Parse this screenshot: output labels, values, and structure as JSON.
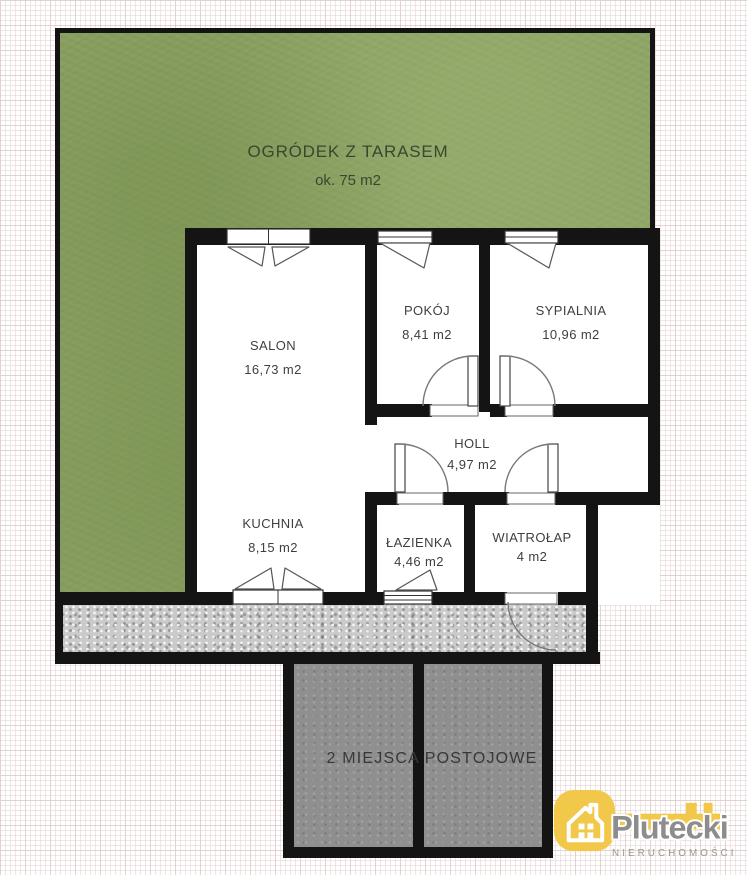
{
  "garden": {
    "name": "OGRÓDEK Z TARASEM",
    "area": "ok. 75 m2"
  },
  "rooms": [
    {
      "id": "salon",
      "name": "SALON",
      "area": "16,73 m2"
    },
    {
      "id": "pokoj",
      "name": "POKÓJ",
      "area": "8,41 m2"
    },
    {
      "id": "sypialnia",
      "name": "SYPIALNIA",
      "area": "10,96 m2"
    },
    {
      "id": "holl",
      "name": "HOLL",
      "area": "4,97 m2"
    },
    {
      "id": "kuchnia",
      "name": "KUCHNIA",
      "area": "8,15 m2"
    },
    {
      "id": "lazienka",
      "name": "ŁAZIENKA",
      "area": "4,46 m2"
    },
    {
      "id": "wiatrolap",
      "name": "WIATROŁAP",
      "area": "4 m2"
    }
  ],
  "parking": {
    "label": "2 MIEJSCA POSTOJOWE"
  },
  "logo": {
    "brand": "Plutecki",
    "subtitle": "NIERUCHOMOŚCI"
  },
  "colors": {
    "grass": "#8ca265",
    "walkway": "#cacaca",
    "parking_stall": "#8f8f8f",
    "wall": "#141414",
    "accent_yellow": "#f2c84a",
    "brand_gray": "#8d8d8d"
  }
}
